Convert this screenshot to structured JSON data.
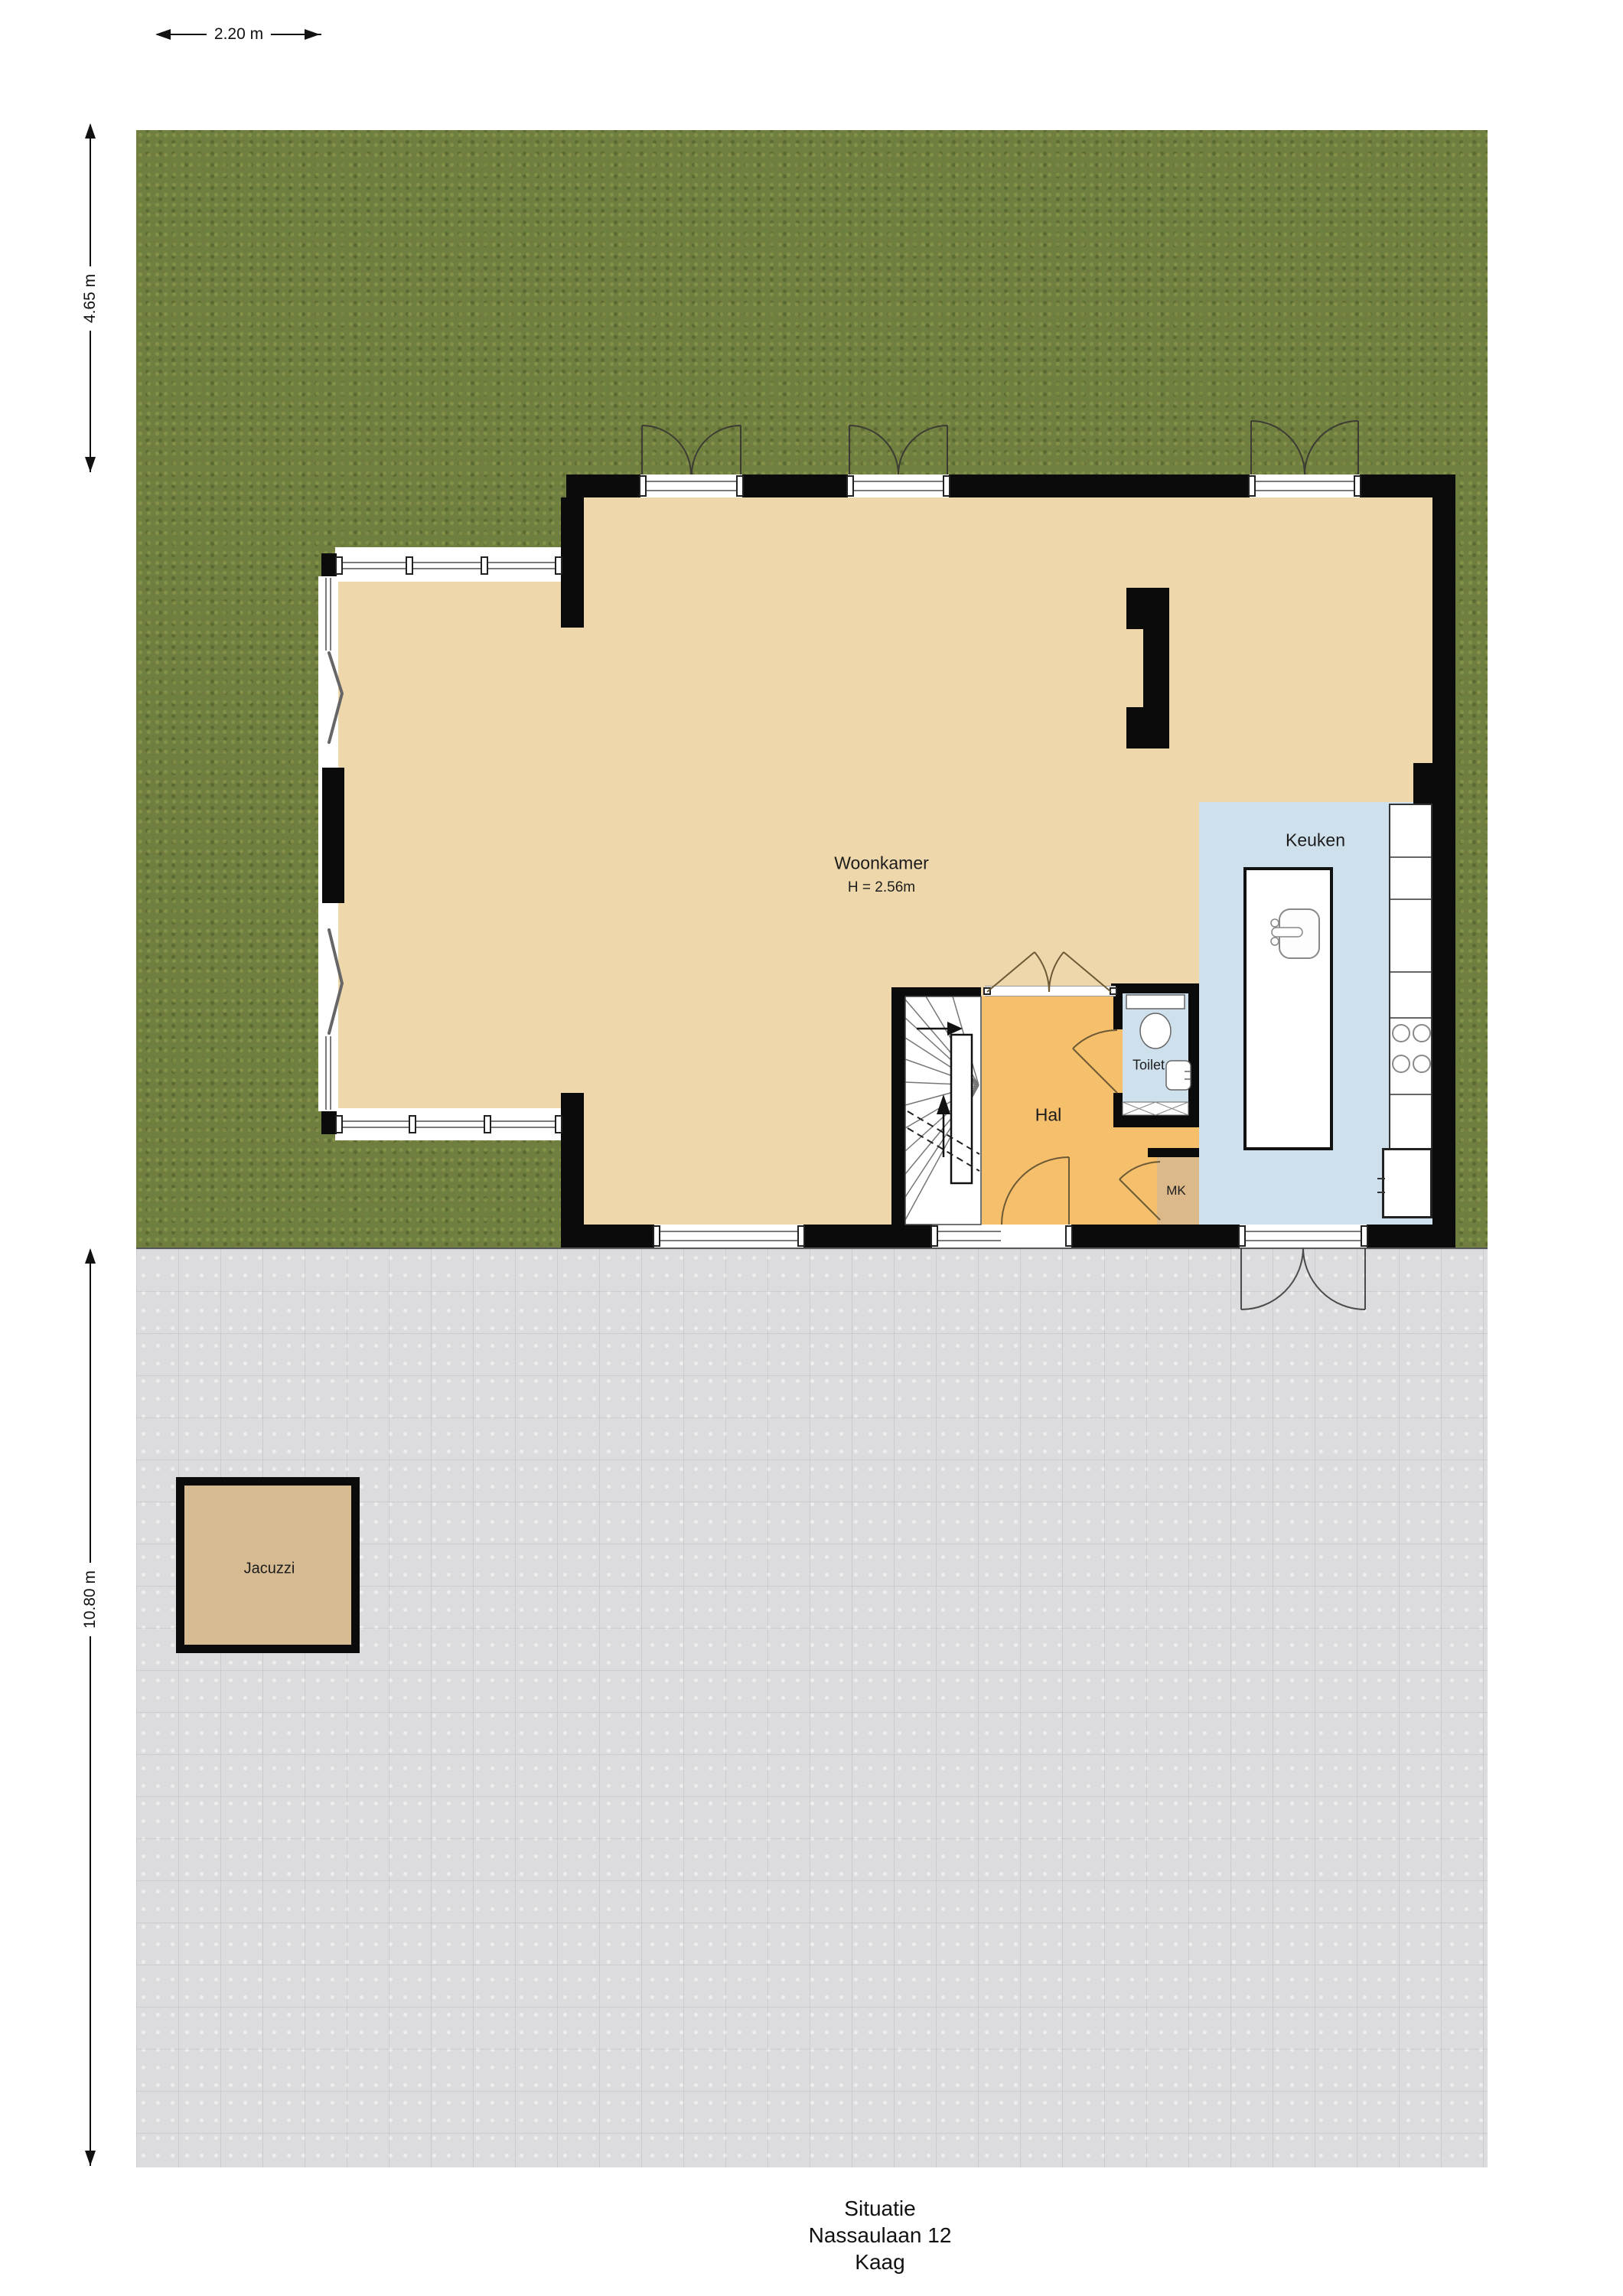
{
  "title_block": {
    "line1": "Situatie",
    "line2": "Nassaulaan 12",
    "line3": "Kaag"
  },
  "dimensions": {
    "garden_width": "2.20 m",
    "garden_depth": "4.65 m",
    "terrace_depth": "10.80 m"
  },
  "rooms": {
    "woonkamer": {
      "label": "Woonkamer",
      "ceiling_height": "H = 2.56m"
    },
    "keuken": {
      "label": "Keuken"
    },
    "hal": {
      "label": "Hal"
    },
    "toilet": {
      "label": "Toilet"
    },
    "meterkast": {
      "label": "MK"
    },
    "jacuzzi": {
      "label": "Jacuzzi"
    }
  },
  "colors": {
    "grass": "#6f7f40",
    "pavement": "#dcdcde",
    "living_floor": "#eed7ab",
    "hal_floor": "#f5bf6c",
    "kitchen_floor": "#cfe0ed",
    "toilet_floor": "#cfe0ed",
    "mk_floor": "#dcb98a",
    "jacuzzi": "#d6bb92",
    "wall": "#0b0b0b"
  }
}
